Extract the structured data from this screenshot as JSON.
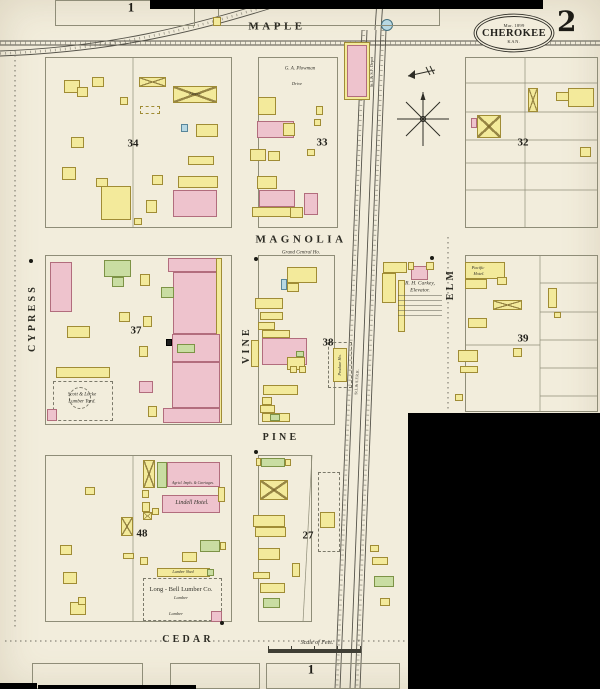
{
  "sheet": {
    "publisher_date": "Mar. 1899",
    "city": "CHEROKEE",
    "state": "KAN.",
    "sheet_number": "2"
  },
  "colors": {
    "paper": "#f2eddc",
    "frame_yellow": "#f3ea9b",
    "brick_pink": "#eec3cd",
    "special_green": "#c9dda2",
    "stone_blue": "#b7d8e3",
    "ink": "#2e2d26"
  },
  "street_labels": [
    {
      "t": "MAPLE",
      "x": 277,
      "y": 27,
      "s": 11
    },
    {
      "t": "MAGNOLIA",
      "x": 301,
      "y": 240,
      "s": 11
    },
    {
      "t": "PINE",
      "x": 281,
      "y": 438,
      "s": 10
    },
    {
      "t": "CEDAR",
      "x": 188,
      "y": 640,
      "s": 10
    },
    {
      "t": "CYPRESS",
      "x": 33,
      "y": 318,
      "s": 10,
      "r": -90
    },
    {
      "t": "VINE",
      "x": 247,
      "y": 345,
      "s": 10,
      "r": -90
    },
    {
      "t": "ELM",
      "x": 451,
      "y": 284,
      "s": 10,
      "r": -90
    }
  ],
  "block_numbers": [
    {
      "t": "34",
      "x": 133,
      "y": 144
    },
    {
      "t": "33",
      "x": 322,
      "y": 143
    },
    {
      "t": "32",
      "x": 523,
      "y": 143
    },
    {
      "t": "37",
      "x": 136,
      "y": 331
    },
    {
      "t": "38",
      "x": 328,
      "y": 343
    },
    {
      "t": "39",
      "x": 523,
      "y": 339
    },
    {
      "t": "48",
      "x": 142,
      "y": 534
    },
    {
      "t": "27",
      "x": 308,
      "y": 536
    }
  ],
  "sheet_marks": [
    {
      "t": "1",
      "x": 131,
      "y": 7,
      "s": 13
    },
    {
      "t": "1",
      "x": 311,
      "y": 669,
      "s": 13
    }
  ],
  "poi_labels": [
    {
      "t": "G. A. Plowman",
      "x": 300,
      "y": 69,
      "s": 5,
      "i": 1
    },
    {
      "t": "Drive",
      "x": 297,
      "y": 84,
      "s": 4.5,
      "i": 1
    },
    {
      "t": "Grand Central Ho.",
      "x": 301,
      "y": 253,
      "s": 5,
      "i": 1
    },
    {
      "t": "R. H. Carkey,",
      "x": 420,
      "y": 284,
      "s": 5.5,
      "i": 1
    },
    {
      "t": "Elevator.",
      "x": 420,
      "y": 291,
      "s": 5.5,
      "i": 1
    },
    {
      "t": "Pacific",
      "x": 478,
      "y": 268,
      "s": 4.5,
      "i": 1
    },
    {
      "t": "Hotel.",
      "x": 479,
      "y": 274,
      "s": 4.5,
      "i": 1
    },
    {
      "t": "Lindell Hotel.",
      "x": 192,
      "y": 503,
      "s": 6,
      "i": 1
    },
    {
      "t": "Agricl. Impls. & Carriages.",
      "x": 193,
      "y": 484,
      "s": 3.8,
      "i": 1
    },
    {
      "t": "Long - Bell Lumber Co.",
      "x": 181,
      "y": 590,
      "s": 6.5
    },
    {
      "t": "Lumber",
      "x": 181,
      "y": 598,
      "s": 4.5,
      "i": 1
    },
    {
      "t": "Lumber",
      "x": 176,
      "y": 614,
      "s": 4.5,
      "i": 1
    },
    {
      "t": "Lumber Shed",
      "x": 183,
      "y": 572,
      "s": 4,
      "i": 1
    },
    {
      "t": "Scott & Locke",
      "x": 82,
      "y": 395,
      "s": 5,
      "i": 1
    },
    {
      "t": "Lumber Yard.",
      "x": 82,
      "y": 402,
      "s": 5,
      "i": 1
    },
    {
      "t": "Scale of Feet.",
      "x": 317,
      "y": 643,
      "s": 6,
      "i": 1
    },
    {
      "t": "Livery",
      "x": 195,
      "y": 94,
      "s": 4.5,
      "i": 1
    },
    {
      "t": "Produce Ho.",
      "x": 340,
      "y": 365,
      "s": 4.2,
      "r": -90,
      "i": 1
    },
    {
      "t": "St.L.& S.F. Depot",
      "x": 372,
      "y": 72,
      "s": 4.2,
      "r": -90
    },
    {
      "t": "St.L.& S.F.R.R.",
      "x": 357,
      "y": 382,
      "s": 4,
      "r": -86
    }
  ],
  "outlines": [
    [
      45,
      57,
      187,
      171
    ],
    [
      258,
      57,
      80,
      171
    ],
    [
      465,
      57,
      133,
      171
    ],
    [
      45,
      255,
      187,
      170
    ],
    [
      258,
      255,
      77,
      170
    ],
    [
      465,
      255,
      133,
      157
    ],
    [
      45,
      455,
      187,
      167
    ],
    [
      258,
      455,
      54,
      167
    ],
    [
      32,
      663,
      111,
      26
    ],
    [
      170,
      663,
      90,
      26
    ],
    [
      266,
      663,
      134,
      26
    ],
    [
      55,
      0,
      140,
      26
    ],
    [
      218,
      0,
      222,
      26
    ]
  ],
  "dashed_areas": [
    [
      53,
      381,
      60,
      40
    ],
    [
      143,
      578,
      79,
      43
    ],
    [
      318,
      472,
      22,
      80
    ],
    [
      328,
      342,
      24,
      46
    ]
  ],
  "dashed_circles": [
    {
      "cx": 80,
      "cy": 398,
      "r": 11
    }
  ],
  "buildings": [
    [
      64,
      80,
      16,
      13,
      "y"
    ],
    [
      77,
      87,
      11,
      10,
      "y"
    ],
    [
      92,
      77,
      12,
      10,
      "y"
    ],
    [
      120,
      97,
      8,
      8,
      "y"
    ],
    [
      71,
      137,
      13,
      11,
      "y"
    ],
    [
      62,
      167,
      14,
      13,
      "y"
    ],
    [
      101,
      186,
      30,
      34,
      "y"
    ],
    [
      96,
      178,
      12,
      9,
      "y"
    ],
    [
      139,
      77,
      27,
      10,
      "y",
      "x"
    ],
    [
      173,
      86,
      44,
      17,
      "y",
      "x"
    ],
    [
      140,
      106,
      20,
      8,
      "y",
      "d"
    ],
    [
      181,
      124,
      7,
      8,
      "b"
    ],
    [
      196,
      124,
      22,
      13,
      "y"
    ],
    [
      188,
      156,
      26,
      9,
      "y"
    ],
    [
      152,
      175,
      11,
      10,
      "y"
    ],
    [
      178,
      176,
      40,
      12,
      "y"
    ],
    [
      173,
      190,
      44,
      27,
      "p"
    ],
    [
      146,
      200,
      11,
      13,
      "y"
    ],
    [
      134,
      218,
      8,
      7,
      "y"
    ],
    [
      258,
      97,
      18,
      18,
      "y"
    ],
    [
      257,
      121,
      37,
      17,
      "p"
    ],
    [
      283,
      123,
      12,
      13,
      "y"
    ],
    [
      316,
      106,
      7,
      9,
      "y"
    ],
    [
      314,
      119,
      7,
      7,
      "y"
    ],
    [
      250,
      149,
      16,
      12,
      "y"
    ],
    [
      268,
      151,
      12,
      10,
      "y"
    ],
    [
      307,
      149,
      8,
      7,
      "y"
    ],
    [
      257,
      176,
      20,
      13,
      "y"
    ],
    [
      259,
      190,
      36,
      17,
      "p"
    ],
    [
      252,
      207,
      47,
      10,
      "y"
    ],
    [
      304,
      193,
      14,
      22,
      "p"
    ],
    [
      290,
      207,
      13,
      11,
      "y"
    ],
    [
      344,
      42,
      26,
      58,
      "y"
    ],
    [
      347,
      45,
      20,
      52,
      "p"
    ],
    [
      477,
      115,
      24,
      23,
      "y",
      "x"
    ],
    [
      471,
      118,
      6,
      10,
      "p"
    ],
    [
      528,
      88,
      10,
      24,
      "y",
      "x"
    ],
    [
      556,
      92,
      16,
      9,
      "y"
    ],
    [
      568,
      88,
      26,
      19,
      "y"
    ],
    [
      580,
      147,
      11,
      10,
      "y"
    ],
    [
      50,
      262,
      22,
      50,
      "p"
    ],
    [
      104,
      260,
      27,
      17,
      "g"
    ],
    [
      112,
      277,
      12,
      10,
      "g"
    ],
    [
      119,
      312,
      11,
      10,
      "y"
    ],
    [
      67,
      326,
      23,
      12,
      "y"
    ],
    [
      56,
      367,
      54,
      11,
      "y"
    ],
    [
      47,
      409,
      10,
      12,
      "p"
    ],
    [
      168,
      258,
      50,
      14,
      "p"
    ],
    [
      173,
      272,
      47,
      62,
      "p"
    ],
    [
      161,
      287,
      13,
      11,
      "g"
    ],
    [
      216,
      258,
      6,
      165,
      "y"
    ],
    [
      172,
      334,
      48,
      28,
      "p"
    ],
    [
      177,
      344,
      18,
      9,
      "g"
    ],
    [
      172,
      362,
      48,
      46,
      "p"
    ],
    [
      163,
      408,
      57,
      15,
      "p"
    ],
    [
      140,
      274,
      10,
      12,
      "y"
    ],
    [
      143,
      316,
      9,
      11,
      "y"
    ],
    [
      139,
      346,
      9,
      11,
      "y"
    ],
    [
      139,
      381,
      14,
      12,
      "p"
    ],
    [
      148,
      406,
      9,
      11,
      "y"
    ],
    [
      166,
      339,
      6,
      7,
      "k"
    ],
    [
      287,
      267,
      30,
      16,
      "y"
    ],
    [
      287,
      283,
      12,
      9,
      "y"
    ],
    [
      281,
      279,
      6,
      11,
      "b"
    ],
    [
      255,
      298,
      28,
      11,
      "y"
    ],
    [
      260,
      312,
      23,
      8,
      "y"
    ],
    [
      258,
      322,
      17,
      8,
      "y"
    ],
    [
      262,
      330,
      28,
      8,
      "y"
    ],
    [
      262,
      338,
      45,
      27,
      "p"
    ],
    [
      296,
      351,
      8,
      6,
      "g"
    ],
    [
      287,
      357,
      18,
      13,
      "y"
    ],
    [
      251,
      340,
      8,
      27,
      "y"
    ],
    [
      290,
      366,
      7,
      7,
      "y"
    ],
    [
      299,
      366,
      7,
      7,
      "y"
    ],
    [
      263,
      385,
      35,
      10,
      "y"
    ],
    [
      262,
      397,
      10,
      8,
      "y"
    ],
    [
      260,
      405,
      15,
      8,
      "y"
    ],
    [
      262,
      413,
      28,
      9,
      "y"
    ],
    [
      270,
      414,
      10,
      7,
      "g"
    ],
    [
      333,
      348,
      14,
      34,
      "y"
    ],
    [
      383,
      262,
      24,
      11,
      "y"
    ],
    [
      382,
      273,
      14,
      30,
      "y"
    ],
    [
      398,
      280,
      7,
      52,
      "y"
    ],
    [
      411,
      266,
      17,
      14,
      "p"
    ],
    [
      408,
      262,
      6,
      8,
      "y"
    ],
    [
      426,
      262,
      8,
      8,
      "y"
    ],
    [
      465,
      262,
      40,
      17,
      "y"
    ],
    [
      465,
      279,
      22,
      10,
      "y"
    ],
    [
      497,
      277,
      10,
      8,
      "y"
    ],
    [
      493,
      300,
      29,
      10,
      "y",
      "x"
    ],
    [
      468,
      318,
      19,
      10,
      "y"
    ],
    [
      548,
      288,
      9,
      20,
      "y"
    ],
    [
      554,
      312,
      7,
      6,
      "y"
    ],
    [
      458,
      350,
      20,
      12,
      "y"
    ],
    [
      513,
      348,
      9,
      9,
      "y"
    ],
    [
      460,
      366,
      18,
      7,
      "y"
    ],
    [
      455,
      394,
      8,
      7,
      "y"
    ],
    [
      143,
      460,
      12,
      28,
      "y",
      "x"
    ],
    [
      157,
      462,
      10,
      26,
      "g"
    ],
    [
      167,
      462,
      53,
      25,
      "p"
    ],
    [
      162,
      495,
      58,
      18,
      "p"
    ],
    [
      218,
      487,
      7,
      15,
      "y"
    ],
    [
      142,
      490,
      7,
      8,
      "y"
    ],
    [
      142,
      502,
      8,
      10,
      "y"
    ],
    [
      152,
      508,
      7,
      7,
      "y"
    ],
    [
      143,
      512,
      9,
      8,
      "y",
      "x"
    ],
    [
      121,
      517,
      12,
      19,
      "y",
      "x"
    ],
    [
      123,
      553,
      11,
      6,
      "y"
    ],
    [
      140,
      557,
      8,
      8,
      "y"
    ],
    [
      200,
      540,
      20,
      12,
      "g"
    ],
    [
      220,
      542,
      6,
      8,
      "y"
    ],
    [
      182,
      552,
      15,
      10,
      "y"
    ],
    [
      157,
      568,
      53,
      9,
      "y"
    ],
    [
      207,
      569,
      7,
      7,
      "g"
    ],
    [
      211,
      611,
      11,
      11,
      "p"
    ],
    [
      85,
      487,
      10,
      8,
      "y"
    ],
    [
      60,
      545,
      12,
      10,
      "y"
    ],
    [
      63,
      572,
      14,
      12,
      "y"
    ],
    [
      70,
      602,
      16,
      13,
      "y"
    ],
    [
      78,
      597,
      8,
      8,
      "y"
    ],
    [
      256,
      458,
      5,
      8,
      "y"
    ],
    [
      261,
      458,
      24,
      9,
      "g"
    ],
    [
      285,
      459,
      6,
      7,
      "y"
    ],
    [
      260,
      480,
      28,
      20,
      "y",
      "x"
    ],
    [
      253,
      515,
      32,
      12,
      "y"
    ],
    [
      255,
      527,
      31,
      10,
      "y"
    ],
    [
      258,
      548,
      22,
      12,
      "y"
    ],
    [
      253,
      572,
      17,
      7,
      "y"
    ],
    [
      260,
      583,
      25,
      10,
      "y"
    ],
    [
      292,
      563,
      8,
      14,
      "y"
    ],
    [
      320,
      512,
      15,
      16,
      "y"
    ],
    [
      263,
      598,
      17,
      10,
      "g"
    ],
    [
      370,
      545,
      9,
      7,
      "y"
    ],
    [
      372,
      557,
      16,
      8,
      "y"
    ],
    [
      374,
      576,
      20,
      11,
      "g"
    ],
    [
      380,
      598,
      10,
      8,
      "y"
    ],
    [
      213,
      17,
      8,
      9,
      "y"
    ]
  ],
  "lot_lines": [
    [
      133,
      57,
      133,
      228
    ],
    [
      525,
      57,
      525,
      228
    ],
    [
      465,
      83,
      598,
      83
    ],
    [
      465,
      112,
      598,
      112
    ],
    [
      465,
      140,
      598,
      140
    ],
    [
      465,
      163,
      598,
      163
    ],
    [
      465,
      190,
      598,
      190
    ],
    [
      540,
      255,
      540,
      412
    ],
    [
      540,
      283,
      598,
      283
    ],
    [
      540,
      312,
      598,
      312
    ],
    [
      540,
      340,
      598,
      340
    ],
    [
      540,
      368,
      598,
      368
    ],
    [
      540,
      396,
      598,
      396
    ],
    [
      465,
      345,
      540,
      345
    ],
    [
      133,
      455,
      133,
      622
    ],
    [
      312,
      455,
      303,
      622
    ]
  ],
  "unit_lines": [
    [
      173,
      198,
      217,
      198
    ],
    [
      173,
      207,
      217,
      207
    ],
    [
      173,
      281,
      221,
      281
    ],
    [
      173,
      289,
      221,
      289
    ],
    [
      173,
      297,
      221,
      297
    ],
    [
      173,
      305,
      221,
      305
    ],
    [
      173,
      313,
      221,
      313
    ],
    [
      173,
      321,
      221,
      321
    ],
    [
      172,
      342,
      220,
      342
    ],
    [
      172,
      350,
      220,
      350
    ],
    [
      172,
      370,
      220,
      370
    ],
    [
      172,
      378,
      220,
      378
    ],
    [
      172,
      386,
      220,
      386
    ],
    [
      172,
      394,
      220,
      394
    ],
    [
      172,
      401,
      220,
      401
    ],
    [
      262,
      346,
      307,
      346
    ],
    [
      262,
      354,
      307,
      354
    ],
    [
      167,
      470,
      220,
      470
    ],
    [
      162,
      505,
      220,
      505
    ]
  ],
  "dotted_lines": [
    [
      15,
      50,
      15,
      628
    ],
    [
      448,
      237,
      448,
      412
    ],
    [
      5,
      641,
      168,
      641
    ],
    [
      208,
      641,
      406,
      641
    ]
  ],
  "railroad": {
    "straight": [
      [
        362,
        30,
        335,
        689
      ],
      [
        367,
        30,
        340,
        689
      ],
      [
        376,
        30,
        350,
        689
      ],
      [
        381,
        30,
        355,
        689
      ],
      [
        386,
        30,
        360,
        689
      ],
      [
        377,
        0,
        375,
        30
      ],
      [
        383,
        0,
        381,
        30
      ]
    ],
    "straight_ties": [
      [
        364,
        30,
        337,
        689
      ],
      [
        383,
        30,
        357,
        689
      ]
    ],
    "horizontal": [
      [
        0,
        41,
        600,
        41
      ],
      [
        0,
        45,
        600,
        45
      ]
    ],
    "horizontal_ties": [
      [
        0,
        43,
        600,
        43
      ]
    ],
    "curves": [
      "M0,51 C110,47 190,26 268,2",
      "M0,56 C115,52 200,31 278,6"
    ],
    "curve_ties": [
      "M0,53.5 C112,49.5 195,28.5 273,4"
    ]
  },
  "fineprint": [
    {
      "x": 398,
      "y": 295,
      "w": 44,
      "h": 24
    }
  ],
  "dots": [
    [
      31,
      261
    ],
    [
      432,
      258
    ],
    [
      222,
      623
    ],
    [
      256,
      452
    ],
    [
      256,
      259
    ]
  ],
  "redactions": [
    [
      150,
      0,
      393,
      9
    ],
    [
      408,
      413,
      192,
      276
    ],
    [
      0,
      683,
      37,
      6
    ],
    [
      38,
      685,
      158,
      4
    ]
  ],
  "compass": {
    "x": 423,
    "y": 119
  },
  "north_arrow": {
    "x": 421,
    "y": 73
  },
  "water_tank": {
    "x": 387,
    "y": 25,
    "r": 5.5
  }
}
